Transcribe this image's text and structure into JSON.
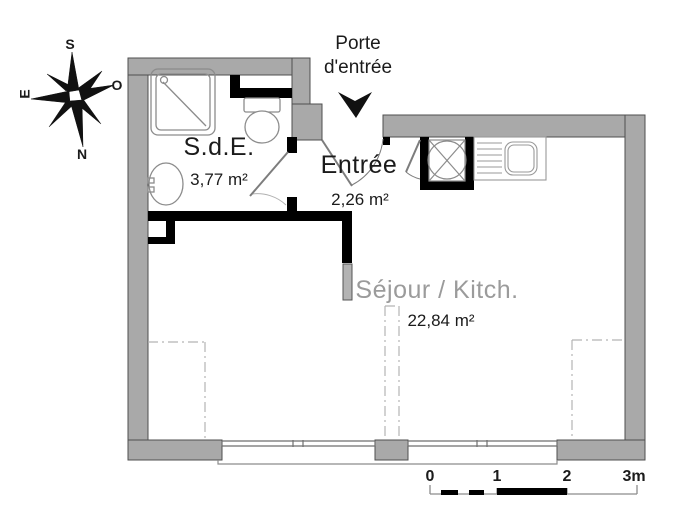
{
  "entry": {
    "label": "Porte\nd'entrée"
  },
  "compass": {
    "n": "N",
    "s": "S",
    "e": "E",
    "o": "O"
  },
  "rooms": {
    "sde": {
      "name": "S.d.E.",
      "area": "3,77 m²"
    },
    "entree": {
      "name": "Entrée",
      "area": "2,26 m²"
    },
    "sejour": {
      "name": "Séjour / Kitch.",
      "area": "22,84 m²"
    }
  },
  "scale_bar": {
    "ticks": [
      "0",
      "1",
      "2",
      "3m"
    ]
  },
  "colors": {
    "exterior_wall": "#a9a9a9",
    "wall_outline": "#4f4f4f",
    "interior_wall": "#000000",
    "fixture_line": "#8c8c8c",
    "sejour_text": "#9b9b9b",
    "text": "#1b1b1b"
  }
}
